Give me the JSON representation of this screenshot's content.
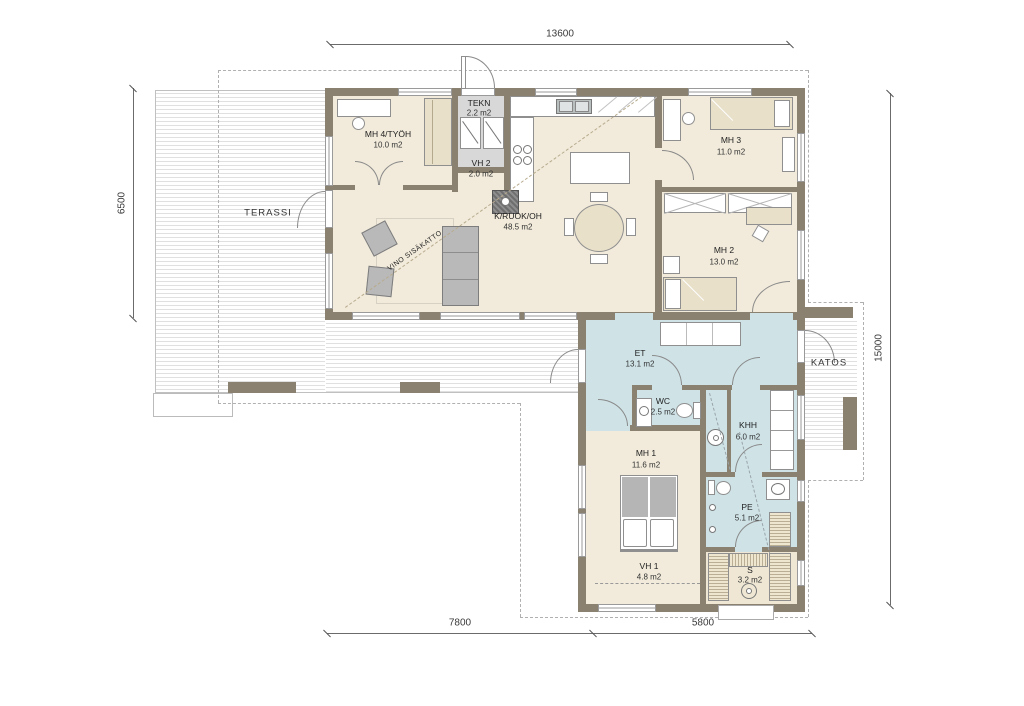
{
  "plan": {
    "rooms": [
      {
        "name": "MH 4/TYÖH",
        "area": "10.0 m2"
      },
      {
        "name": "TEKN",
        "area": "2.2 m2"
      },
      {
        "name": "VH 2",
        "area": "2.0 m2"
      },
      {
        "name": "K/RUOK/OH",
        "area": "48.5 m2"
      },
      {
        "name": "MH 3",
        "area": "11.0 m2"
      },
      {
        "name": "MH 2",
        "area": "13.0 m2"
      },
      {
        "name": "ET",
        "area": "13.1 m2"
      },
      {
        "name": "WC",
        "area": "2.5 m2"
      },
      {
        "name": "KHH",
        "area": "6.0 m2"
      },
      {
        "name": "MH 1",
        "area": "11.6 m2"
      },
      {
        "name": "PE",
        "area": "5.1 m2"
      },
      {
        "name": "VH 1",
        "area": "4.8 m2"
      },
      {
        "name": "S",
        "area": "3.2 m2"
      }
    ],
    "outdoor_labels": {
      "terassi": "TERASSI",
      "katos": "KATOS"
    },
    "annotations": {
      "sloped_ceiling": "VINO SISÄKATTO"
    },
    "dimensions": {
      "top": "13600",
      "left": "6500",
      "right": "15000",
      "bottom_left": "7800",
      "bottom_right": "5800"
    },
    "colors": {
      "wall": "#8a8171",
      "room_floor": "#f2ebdb",
      "wet_floor": "#cfe3e7",
      "tech_floor": "#d8d8d8",
      "deck_stripe": "#e0e0e0",
      "furniture_gray": "#b9b9b9",
      "furniture_tan": "#e9e0ca"
    }
  }
}
